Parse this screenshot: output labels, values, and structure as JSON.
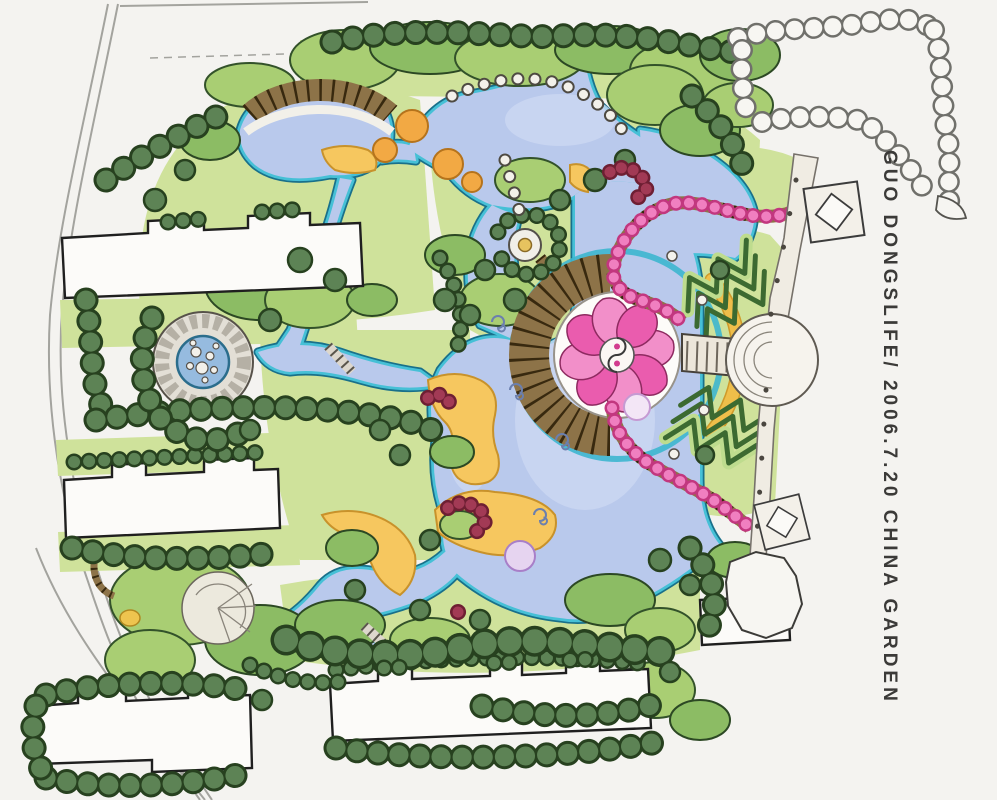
{
  "caption": {
    "text": "GUO DONGSLIFE/ 2006.7.20 CHINA GARDEN"
  },
  "colors": {
    "paper": "#f4f3f0",
    "lawn": "#cfe29b",
    "canopy": "#a9ce73",
    "canopy-dark": "#8cbc64",
    "tree": "#5d8355",
    "tree-outline": "#27411f",
    "lake": "#b9c9ec",
    "lake-edge": "#46c0d6",
    "sand": "#f6c75f",
    "sand-outline": "#c8922b",
    "pink": "#f07fc0",
    "pink-dark": "#c2377f",
    "maroon": "#a23a55",
    "paving": "#8d7348",
    "yellow-path": "#efbe4a",
    "orange-tree": "#f2a944",
    "chevron": "#3c6a31",
    "promenade": "#f0ece3",
    "road": "#a3a39e",
    "lilac": "#e6d4f0"
  }
}
